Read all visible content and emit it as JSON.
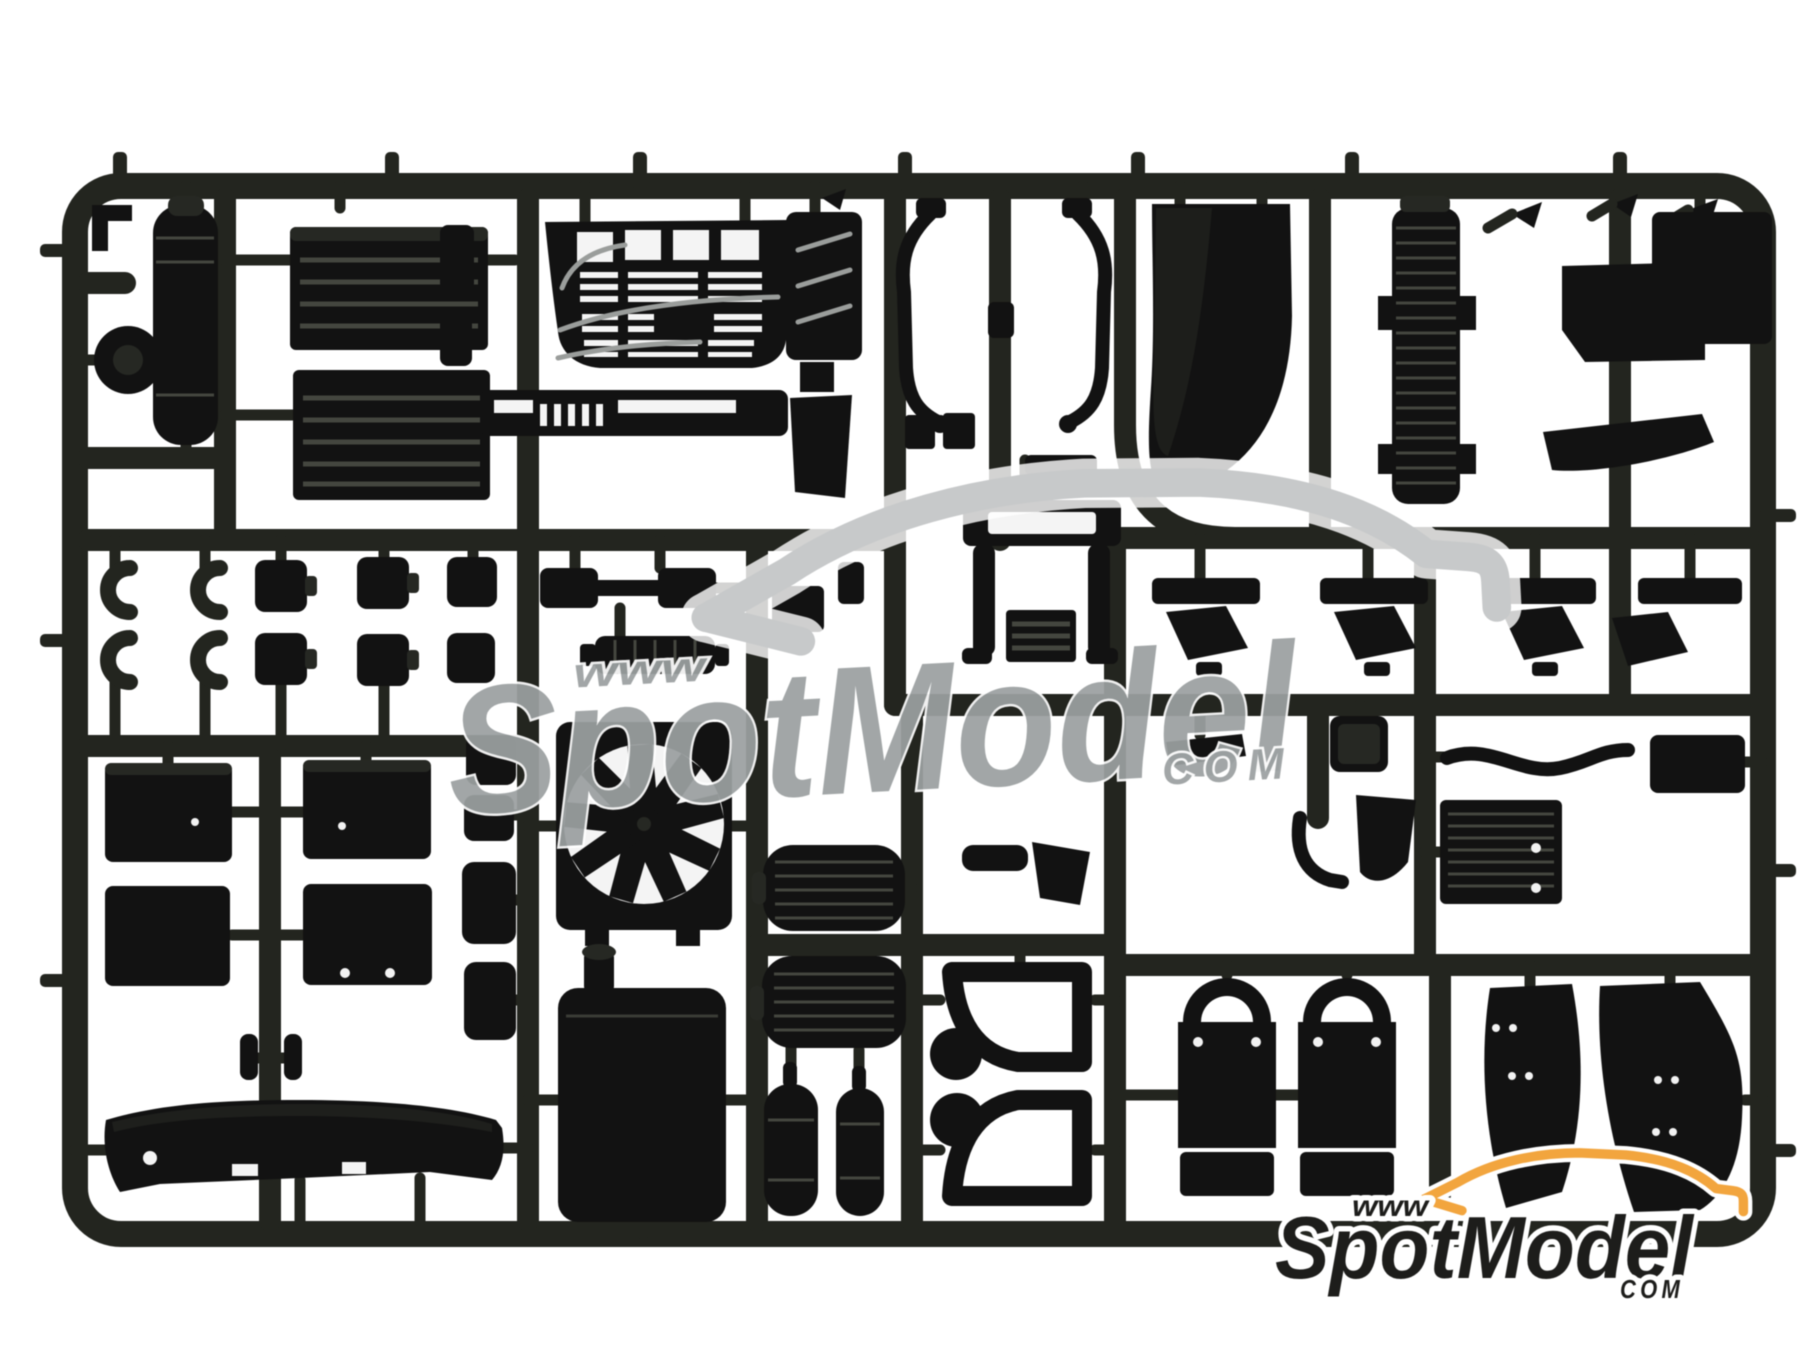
{
  "colors": {
    "background": "#ffffff",
    "runner": "#23251f",
    "part": "#121212",
    "part_soft": "#262823",
    "slot": "#f4f4f4",
    "rib": "#44463f",
    "rivet": "#f2f2f2",
    "watermark_text": "#9ba0a1",
    "watermark_line": "#c7c9ca",
    "logo_text": "#1d1d1b",
    "logo_orange": "#f2a53e",
    "halo": "#ffffff"
  },
  "watermark": {
    "www": "www",
    "name": "SpotModel",
    "tld": "COM"
  },
  "logo": {
    "www": "www",
    "name": "SpotModel",
    "tld": "COM"
  },
  "parts": [
    "sprue-frame",
    "air-tank",
    "road-wheel",
    "ribbed-side-panel",
    "front-grille",
    "lower-grille-bar",
    "vent-panel",
    "mirror-arm",
    "corner-deflector-panel",
    "ribbed-intake-stack",
    "roof-storage-box",
    "sun-visor",
    "sprue-dart-clip",
    "pipe-clamp",
    "coupling-drum",
    "dumbbell-coupling",
    "cab-rear-window-frame",
    "ribbed-plate",
    "entry-step-bracket",
    "wing-mirror-housing",
    "radiator-fan",
    "mirror-housing",
    "fuel-tank",
    "ribbed-brake-drum",
    "air-reservoir-cylinder",
    "chassis-bracket-frame",
    "battery-box",
    "front-bumper-spoiler",
    "mud-flap",
    "wheel-arch-fender",
    "air-hose-connector",
    "radiator-core-panel"
  ]
}
